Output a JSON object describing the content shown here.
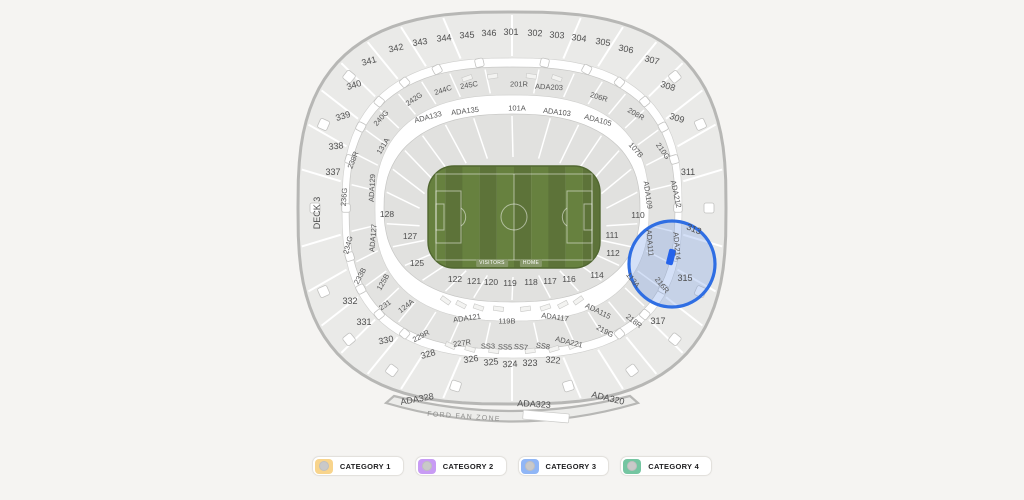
{
  "map": {
    "upper_sections": [
      "342",
      "343",
      "344",
      "345",
      "346",
      "301",
      "302",
      "303",
      "304",
      "305",
      "306",
      "341",
      "307",
      "340",
      "308",
      "339",
      "309",
      "338",
      "337",
      "311",
      "332",
      "331",
      "330",
      "313",
      "315",
      "317",
      "328",
      "326",
      "325",
      "324",
      "323",
      "322",
      "ADA328",
      "ADA323",
      "ADA320"
    ],
    "mid_sections": [
      "240G",
      "242G",
      "244C",
      "245C",
      "201R",
      "ADA203",
      "206R",
      "208R",
      "210G",
      "ADA212",
      "ADA214",
      "216R",
      "218R",
      "219G",
      "ADA221",
      "SS8",
      "SS7",
      "SS5",
      "SS3",
      "227R",
      "229R",
      "231",
      "233B",
      "234G",
      "236G",
      "238R"
    ],
    "walkway_sections": [
      "ADA133",
      "ADA135",
      "101A",
      "ADA103",
      "ADA105",
      "107B",
      "ADA109",
      "ADA111",
      "113A",
      "ADA115",
      "ADA117",
      "119B",
      "ADA121",
      "124A",
      "125B",
      "ADA127",
      "ADA129",
      "131A"
    ],
    "lower_sections": [
      "128",
      "127",
      "125",
      "122",
      "121",
      "120",
      "119",
      "118",
      "117",
      "116",
      "114",
      "110",
      "111",
      "112"
    ],
    "deck_label": "DECK 3",
    "fan_zone_label": "FORD FAN ZONE",
    "field": {
      "visitors_label": "VISITORS",
      "home_label": "HOME",
      "grass_color": "#5d7339"
    },
    "highlight": {
      "ring_color": "#2f6ee3",
      "fill_color": "rgba(125,162,230,0.33)",
      "marker_color": "#2563eb"
    }
  },
  "legend": {
    "items": [
      {
        "label": "CATEGORY 1",
        "color": "#f8d48c"
      },
      {
        "label": "CATEGORY 2",
        "color": "#c89bf4"
      },
      {
        "label": "CATEGORY 3",
        "color": "#90b6f6"
      },
      {
        "label": "CATEGORY 4",
        "color": "#74c5a1"
      }
    ]
  }
}
